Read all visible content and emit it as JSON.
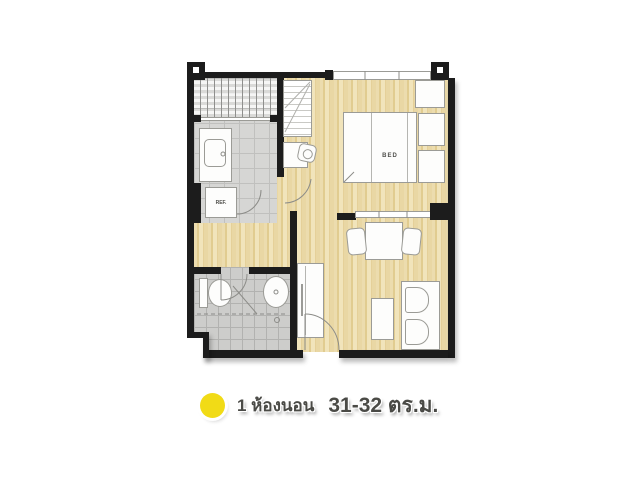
{
  "floorplan": {
    "bed_label": "BED",
    "fridge_label": "REF."
  },
  "legend": {
    "marker_color": "#F1DB16",
    "unit_type": "1 ห้องนอน",
    "unit_size": "31-32 ตร.ม."
  },
  "colors": {
    "wall": "#1c1c1c",
    "wood_floor": "#e9d7a4",
    "tile_floor": "#d6d6d4",
    "furniture": "#fdfdfc"
  }
}
